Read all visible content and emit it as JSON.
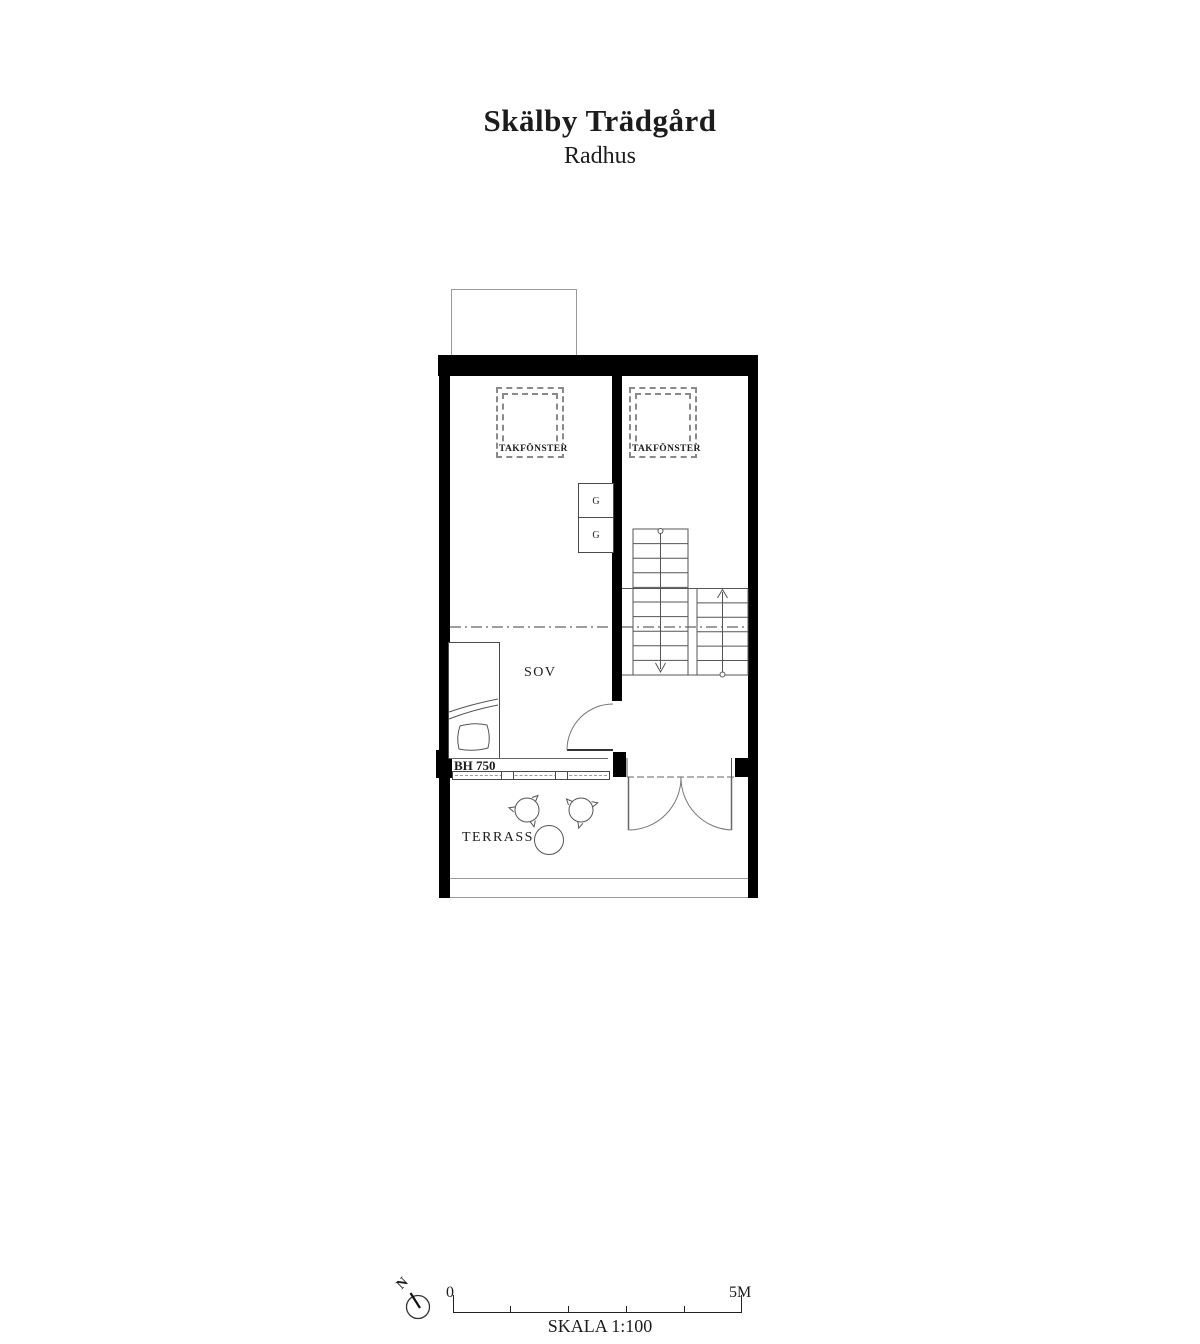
{
  "title": {
    "main": "Skälby Trädgård",
    "subtitle": "Radhus"
  },
  "plan": {
    "bedroom_label": "SOV",
    "terrace_label": "TERRASS",
    "skylight_left_label": "TAKFÖNSTER",
    "skylight_right_label": "TAKFÖNSTER",
    "wardrobe_top_label": "G",
    "wardrobe_bottom_label": "G",
    "window_sill_label": "BH 750"
  },
  "scalebar": {
    "zero": "0",
    "five": "5M",
    "scale": "SKALA 1:100",
    "north": "N"
  },
  "colors": {
    "wall": "#000000",
    "line": "#555555",
    "light_line": "#999999",
    "text": "#1c1c1c"
  }
}
